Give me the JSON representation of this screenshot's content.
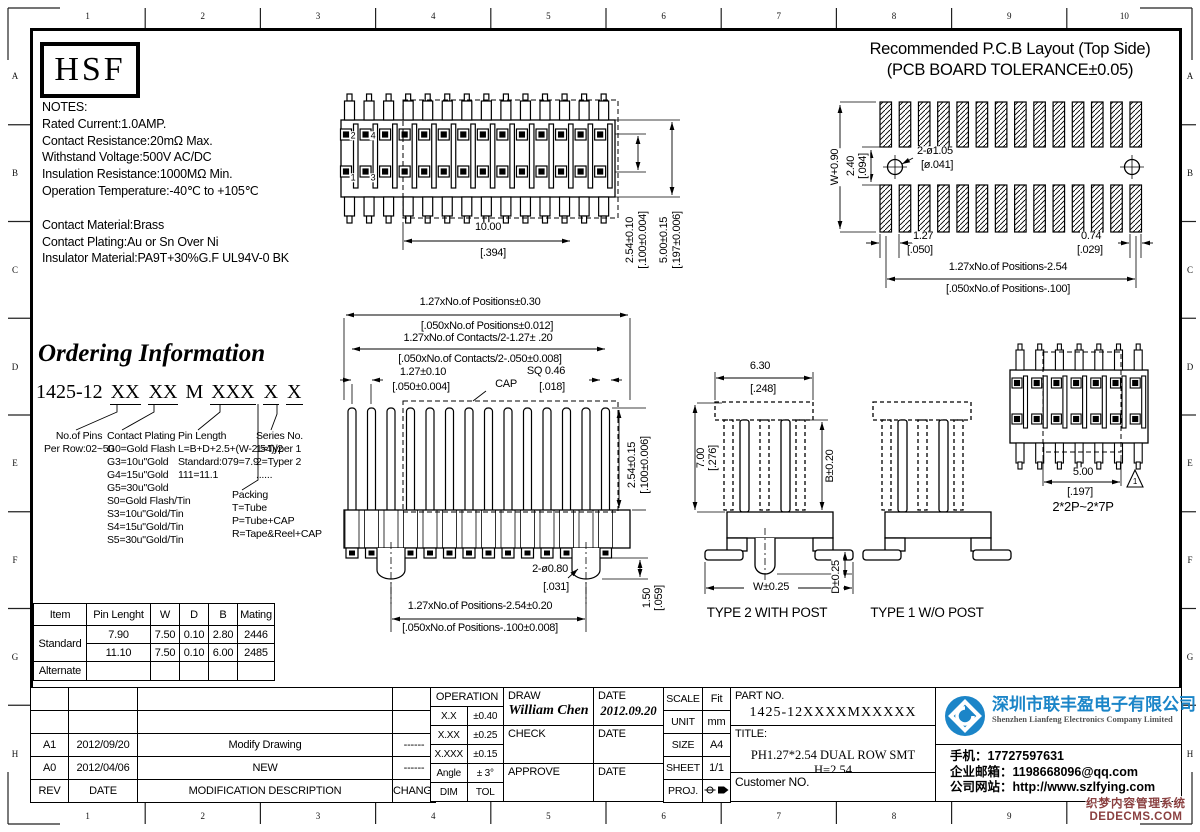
{
  "frame": {
    "top_numbers": [
      "1",
      "2",
      "3",
      "4",
      "5",
      "6",
      "7",
      "8",
      "9",
      "10"
    ],
    "bottom_numbers": [
      "1",
      "2",
      "3",
      "4",
      "5",
      "6",
      "7",
      "8",
      "9"
    ],
    "side_letters": [
      "A",
      "B",
      "C",
      "D",
      "E",
      "F",
      "G",
      "H"
    ]
  },
  "logo_box": {
    "text": "HSF"
  },
  "notes": {
    "block1": [
      "NOTES:",
      "Rated Current:1.0AMP.",
      "Contact Resistance:20mΩ Max.",
      "Withstand Voltage:500V AC/DC",
      "Insulation Resistance:1000MΩ Min.",
      "Operation Temperature:-40℃ to +105℃"
    ],
    "block2": [
      "Contact Material:Brass",
      "Contact Plating:Au or Sn Over Ni",
      "Insulator Material:PA9T+30%G.F UL94V-0 BK"
    ]
  },
  "pcb_layout": {
    "title_line1": "Recommended P.C.B Layout (Top Side)",
    "title_line2": "(PCB BOARD TOLERANCE±0.05)",
    "dims": {
      "w": "W+0.90",
      "gap": "2.40",
      "gap_in": "[.094]",
      "hole": "2-ø1.05",
      "hole_in": "[ø.041]",
      "pitch": "1.27",
      "pitch_in": "[.050]",
      "end": "0.74",
      "end_in": "[.029]",
      "span": "1.27xNo.of Positions-2.54",
      "span_in": "[.050xNo.of Positions-.100]"
    }
  },
  "top_view": {
    "pin_1": "1",
    "pin_2": "2",
    "pin_3": "3",
    "pin_4": "4",
    "span": "10.00",
    "span_in": "[.394]",
    "pitch": "2.54±0.10",
    "pitch_in": "[.100±0.004]",
    "width": "5.00±0.15",
    "width_in": "[.197±0.006]"
  },
  "ordering": {
    "title": "Ordering Information",
    "part_segments": [
      {
        "text": "1425-12",
        "underline": false
      },
      {
        "text": "XX",
        "underline": true
      },
      {
        "text": "XX",
        "underline": true
      },
      {
        "text": "M",
        "underline": false
      },
      {
        "text": "XXX",
        "underline": true
      },
      {
        "text": "X",
        "underline": true
      },
      {
        "text": "X",
        "underline": true
      }
    ],
    "col_pins": {
      "header": "No.of Pins",
      "items": [
        "Per Row:02~50"
      ]
    },
    "col_plating": {
      "header": "Contact Plating",
      "items": [
        "G0=Gold Flash",
        "G3=10u\"Gold",
        "G4=15u\"Gold",
        "G5=30u\"Gold",
        "S0=Gold Flash/Tin",
        "S3=10u\"Gold/Tin",
        "S4=15u\"Gold/Tin",
        "S5=30u\"Gold/Tin"
      ]
    },
    "col_length": {
      "header": "Pin Length",
      "items": [
        "L=B+D+2.5+(W-2.54)/2",
        "Standard:079=7.9",
        "111=11.1"
      ]
    },
    "col_series": {
      "header": "Series No.",
      "items": [
        "1=Typer 1",
        "2=Typer 2",
        "......"
      ]
    },
    "col_packing": {
      "header": "Packing",
      "items": [
        "T=Tube",
        "P=Tube+CAP",
        "R=Tape&Reel+CAP"
      ]
    }
  },
  "front_view": {
    "pos": "1.27xNo.of Positions±0.30",
    "pos_in": "[.050xNo.of Positions±0.012]",
    "contacts": "1.27xNo.of Contacts/2-1.27± .20",
    "contacts_in": "[.050xNo.of Contacts/2-.050±0.008]",
    "pitch": "1.27±0.10",
    "pitch_in": "[.050±0.004]",
    "cap": "CAP",
    "sq": "SQ 0.46",
    "sq_in": "[.018]",
    "height": "2.54±0.15",
    "height_in": "[.100±0.006]",
    "hole": "2-ø0.80",
    "hole_in": "[.031]",
    "foot": "1.50",
    "foot_in": "[.059]",
    "span": "1.27xNo.of Positions-2.54±0.20",
    "span_in": "[.050xNo.of Positions-.100±0.008]"
  },
  "side_views": {
    "dim_top": "6.30",
    "dim_top_in": "[.248]",
    "dim_h": "7.00",
    "dim_h_in": "[.276]",
    "dim_b": "B±0.20",
    "dim_w": "W±0.25",
    "dim_d": "D±0.25",
    "type2": "TYPE 2 WITH POST",
    "type1": "TYPE 1 W/O POST"
  },
  "small_view": {
    "dim": "5.00",
    "dim_in": "[.197]",
    "label": "2*2P~2*7P",
    "marker": "1"
  },
  "spec_table": {
    "headers": [
      "Item",
      "Pin Lenght",
      "W",
      "D",
      "B",
      "Mating"
    ],
    "group_standard": "Standard",
    "group_alternate": "Alternate",
    "rows": [
      [
        "7.90",
        "7.50",
        "0.10",
        "2.80",
        "2446"
      ],
      [
        "11.10",
        "7.50",
        "0.10",
        "6.00",
        "2485"
      ]
    ]
  },
  "revision_table": {
    "rows": [
      [
        "",
        "",
        "",
        ""
      ],
      [
        "",
        "",
        "",
        ""
      ],
      [
        "A1",
        "2012/09/20",
        "Modify Drawing",
        "------"
      ],
      [
        "A0",
        "2012/04/06",
        "NEW",
        "------"
      ]
    ],
    "footer": [
      "REV",
      "DATE",
      "MODIFICATION DESCRIPTION",
      "CHANGE"
    ]
  },
  "title_block": {
    "operation_header": "OPERATION",
    "operation_rows": [
      [
        "X.X",
        "±0.40"
      ],
      [
        "X.XX",
        "±0.25"
      ],
      [
        "X.XXX",
        "±0.15"
      ],
      [
        "Angle",
        "± 3°"
      ],
      [
        "DIM",
        "TOL"
      ]
    ],
    "draw_label": "DRAW",
    "draw_name": "William Chen",
    "draw_date": "2012.09.20",
    "check_label": "CHECK",
    "approve_label": "APPROVE",
    "date_label": "DATE",
    "meta_rows": [
      [
        "SCALE",
        "Fit"
      ],
      [
        "UNIT",
        "mm"
      ],
      [
        "SIZE",
        "A4"
      ],
      [
        "SHEET",
        "1/1"
      ]
    ],
    "proj_label": "PROJ.",
    "part_no_label": "PART NO.",
    "part_no": "1425-12XXXXMXXXXX",
    "title_label": "TITLE:",
    "title": "PH1.27*2.54 DUAL ROW SMT H=2.54",
    "customer_label": "Customer NO."
  },
  "company": {
    "name_cn": "深圳市联丰盈电子有限公司",
    "name_en": "Shenzhen Lianfeng Electronics Company Limited",
    "brand_blue": "#1b85c8",
    "contacts": [
      {
        "label": "手机：",
        "value": "17727597631"
      },
      {
        "label": "企业邮箱：",
        "value": "1198668096@qq.com"
      },
      {
        "label": "公司网站：",
        "value": "http://www.szlfying.com"
      }
    ]
  },
  "watermark": {
    "line1": "织梦内容管理系统",
    "line2": "DEDECMS.COM"
  }
}
